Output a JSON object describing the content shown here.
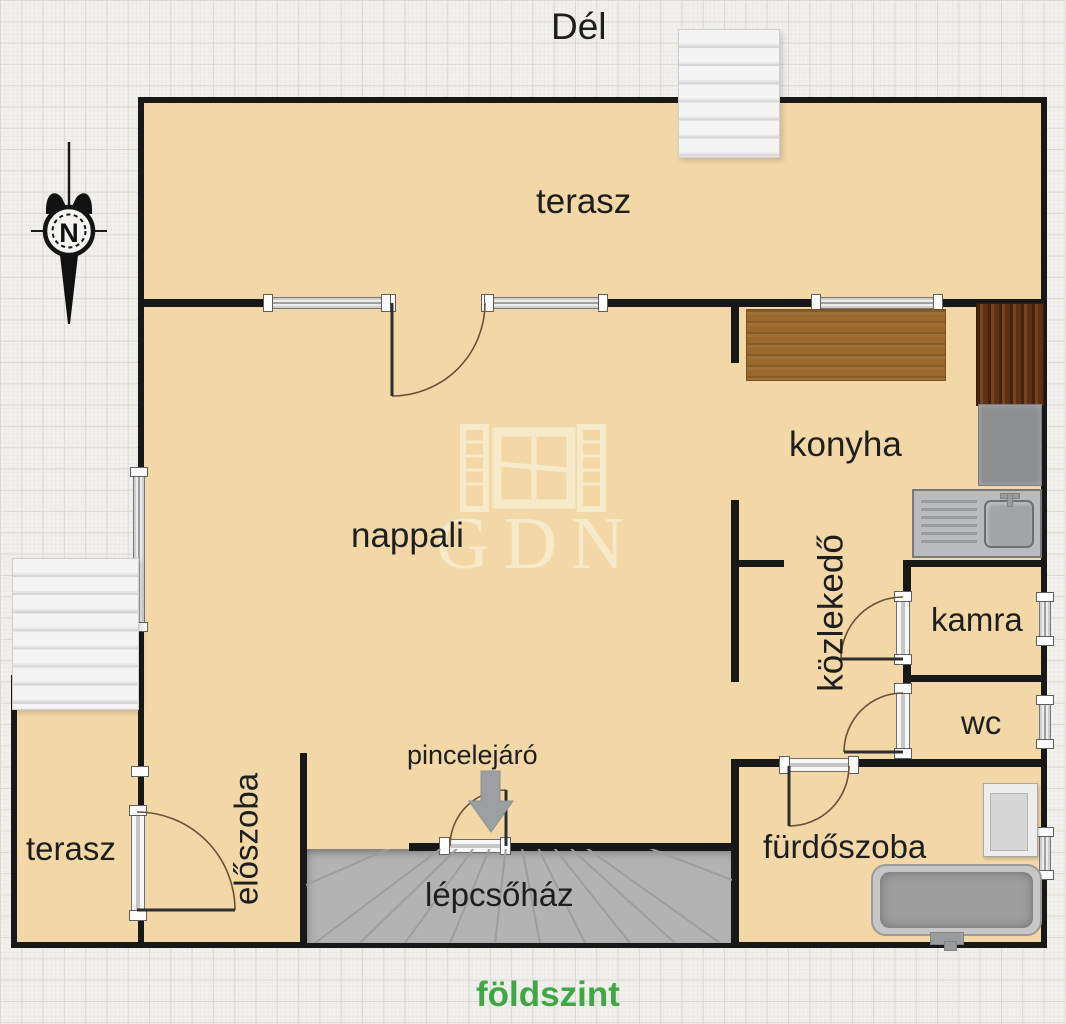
{
  "plan": {
    "floor_label": "földszint",
    "orientation_label": "Dél",
    "compass_label": "N",
    "watermark_text": "GDN"
  },
  "rooms": {
    "terrace_top": "terasz",
    "kitchen": "konyha",
    "living_room": "nappali",
    "hallway": "közlekedő",
    "pantry": "kamra",
    "toilet": "wc",
    "bathroom": "fürdőszoba",
    "entrance_hall": "előszoba",
    "terrace_side": "terasz",
    "basement_entry_label": "pincelejáró",
    "stairwell": "lépcsőház"
  },
  "colors": {
    "floor": "#f2d8a6",
    "wall": "#181818",
    "background": "#f2f1ef",
    "stairwell_fill": "#b3b3b3",
    "counter_wood": "#9a682c",
    "cabinet_wood": "#5e3114",
    "floor_label_green": "#3fa845",
    "label_text": "#1e1e1e"
  }
}
